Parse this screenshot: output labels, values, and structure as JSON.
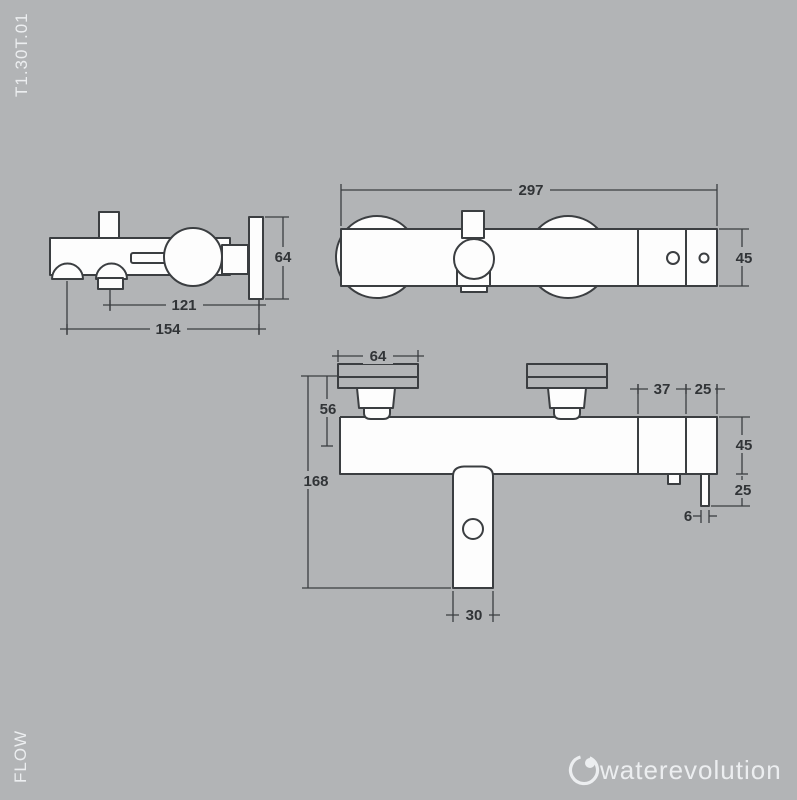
{
  "page": {
    "product_code": "T1.30T.01",
    "series_name": "FLOW",
    "brand": "waterevolution"
  },
  "colors": {
    "background": "#b2b4b6",
    "line": "#3b3e41",
    "fill": "#fdfdfd",
    "dim_text": "#313437",
    "label": "#eceef0"
  },
  "drawing": {
    "type": "technical-dimension-drawing",
    "subject": "wall-mounted single-lever bath shower mixer, three orthographic views"
  },
  "side_view": {
    "plate_height": "64",
    "inlet_to_wall": "121",
    "overall_depth": "154"
  },
  "top_view": {
    "overall_width": "297",
    "body_depth": "45"
  },
  "front_view": {
    "flange_width": "64",
    "wall_to_axis": "56",
    "overall_height": "168",
    "spout_width": "30",
    "section_width": "37",
    "end_section_width": "25",
    "body_height": "45",
    "outlet_drop": "25",
    "outlet_diameter": "6"
  }
}
